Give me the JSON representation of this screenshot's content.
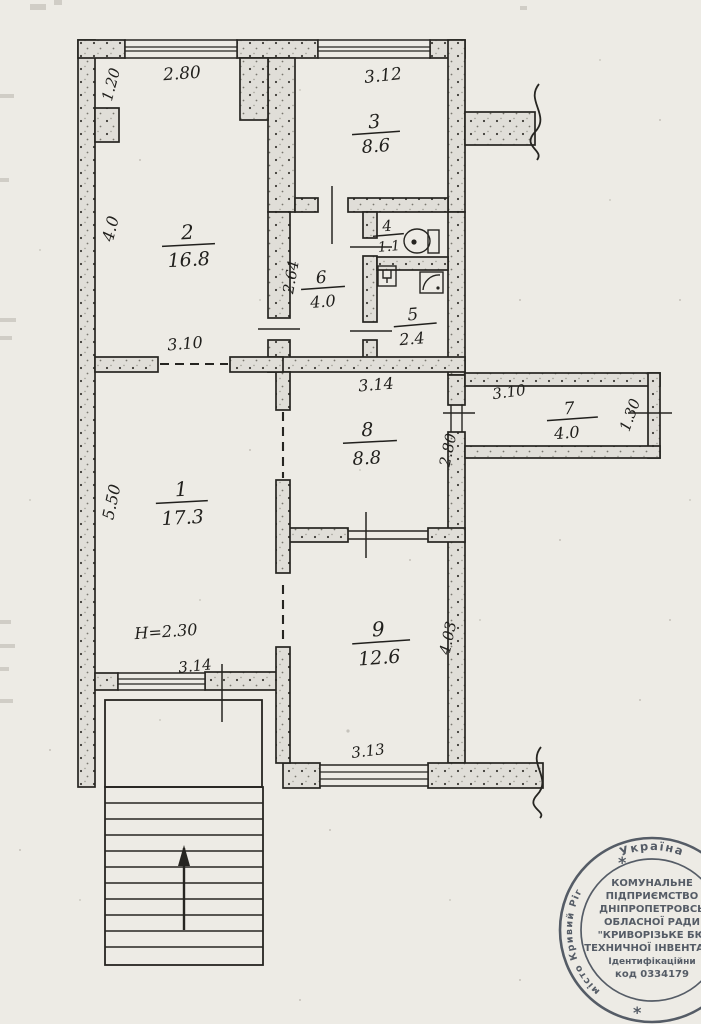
{
  "rooms": [
    {
      "number": "1",
      "area": "17.3"
    },
    {
      "number": "2",
      "area": "16.8"
    },
    {
      "number": "3",
      "area": "8.6"
    },
    {
      "number": "4",
      "area": "1.1"
    },
    {
      "number": "5",
      "area": "2.4"
    },
    {
      "number": "6",
      "area": "4.0"
    },
    {
      "number": "7",
      "area": "4.0"
    },
    {
      "number": "8",
      "area": "8.8"
    },
    {
      "number": "9",
      "area": "12.6"
    }
  ],
  "dimensions": {
    "niche_depth": "1.20",
    "room2_top": "2.80",
    "room3_top": "3.12",
    "room2_left": "4.0",
    "room6_left": "2.64",
    "room2_bottom": "3.10",
    "room8_top": "3.14",
    "room8_right": "2.80",
    "room7_top": "3.10",
    "room7_right": "1.30",
    "room1_left": "5.50",
    "ceiling_height": "Н=2.30",
    "room1_bottom": "3.14",
    "room9_bottom": "3.13",
    "room9_right": "4.03"
  },
  "stamp": {
    "ring_top": "Україна",
    "ring_left": "місто Кривий Ріг",
    "star": "*",
    "lines": [
      "КОМУНАЛЬНЕ",
      "ПІДПРИЄМСТВО",
      "ДНІПРОПЕТРОВСЬ",
      "ОБЛАСНОЇ РАДИ",
      "\"КРИВОРІЗЬКЕ БЮ",
      "ТЕХНИЧНОЇ ІНВЕНТАРИ",
      "Ідентифікаційни",
      "код 0334179"
    ]
  },
  "colors": {
    "ink": "#262521",
    "paper": "#edebe5",
    "wall_fill": "#e0ded8",
    "stamp": "#454d59"
  }
}
